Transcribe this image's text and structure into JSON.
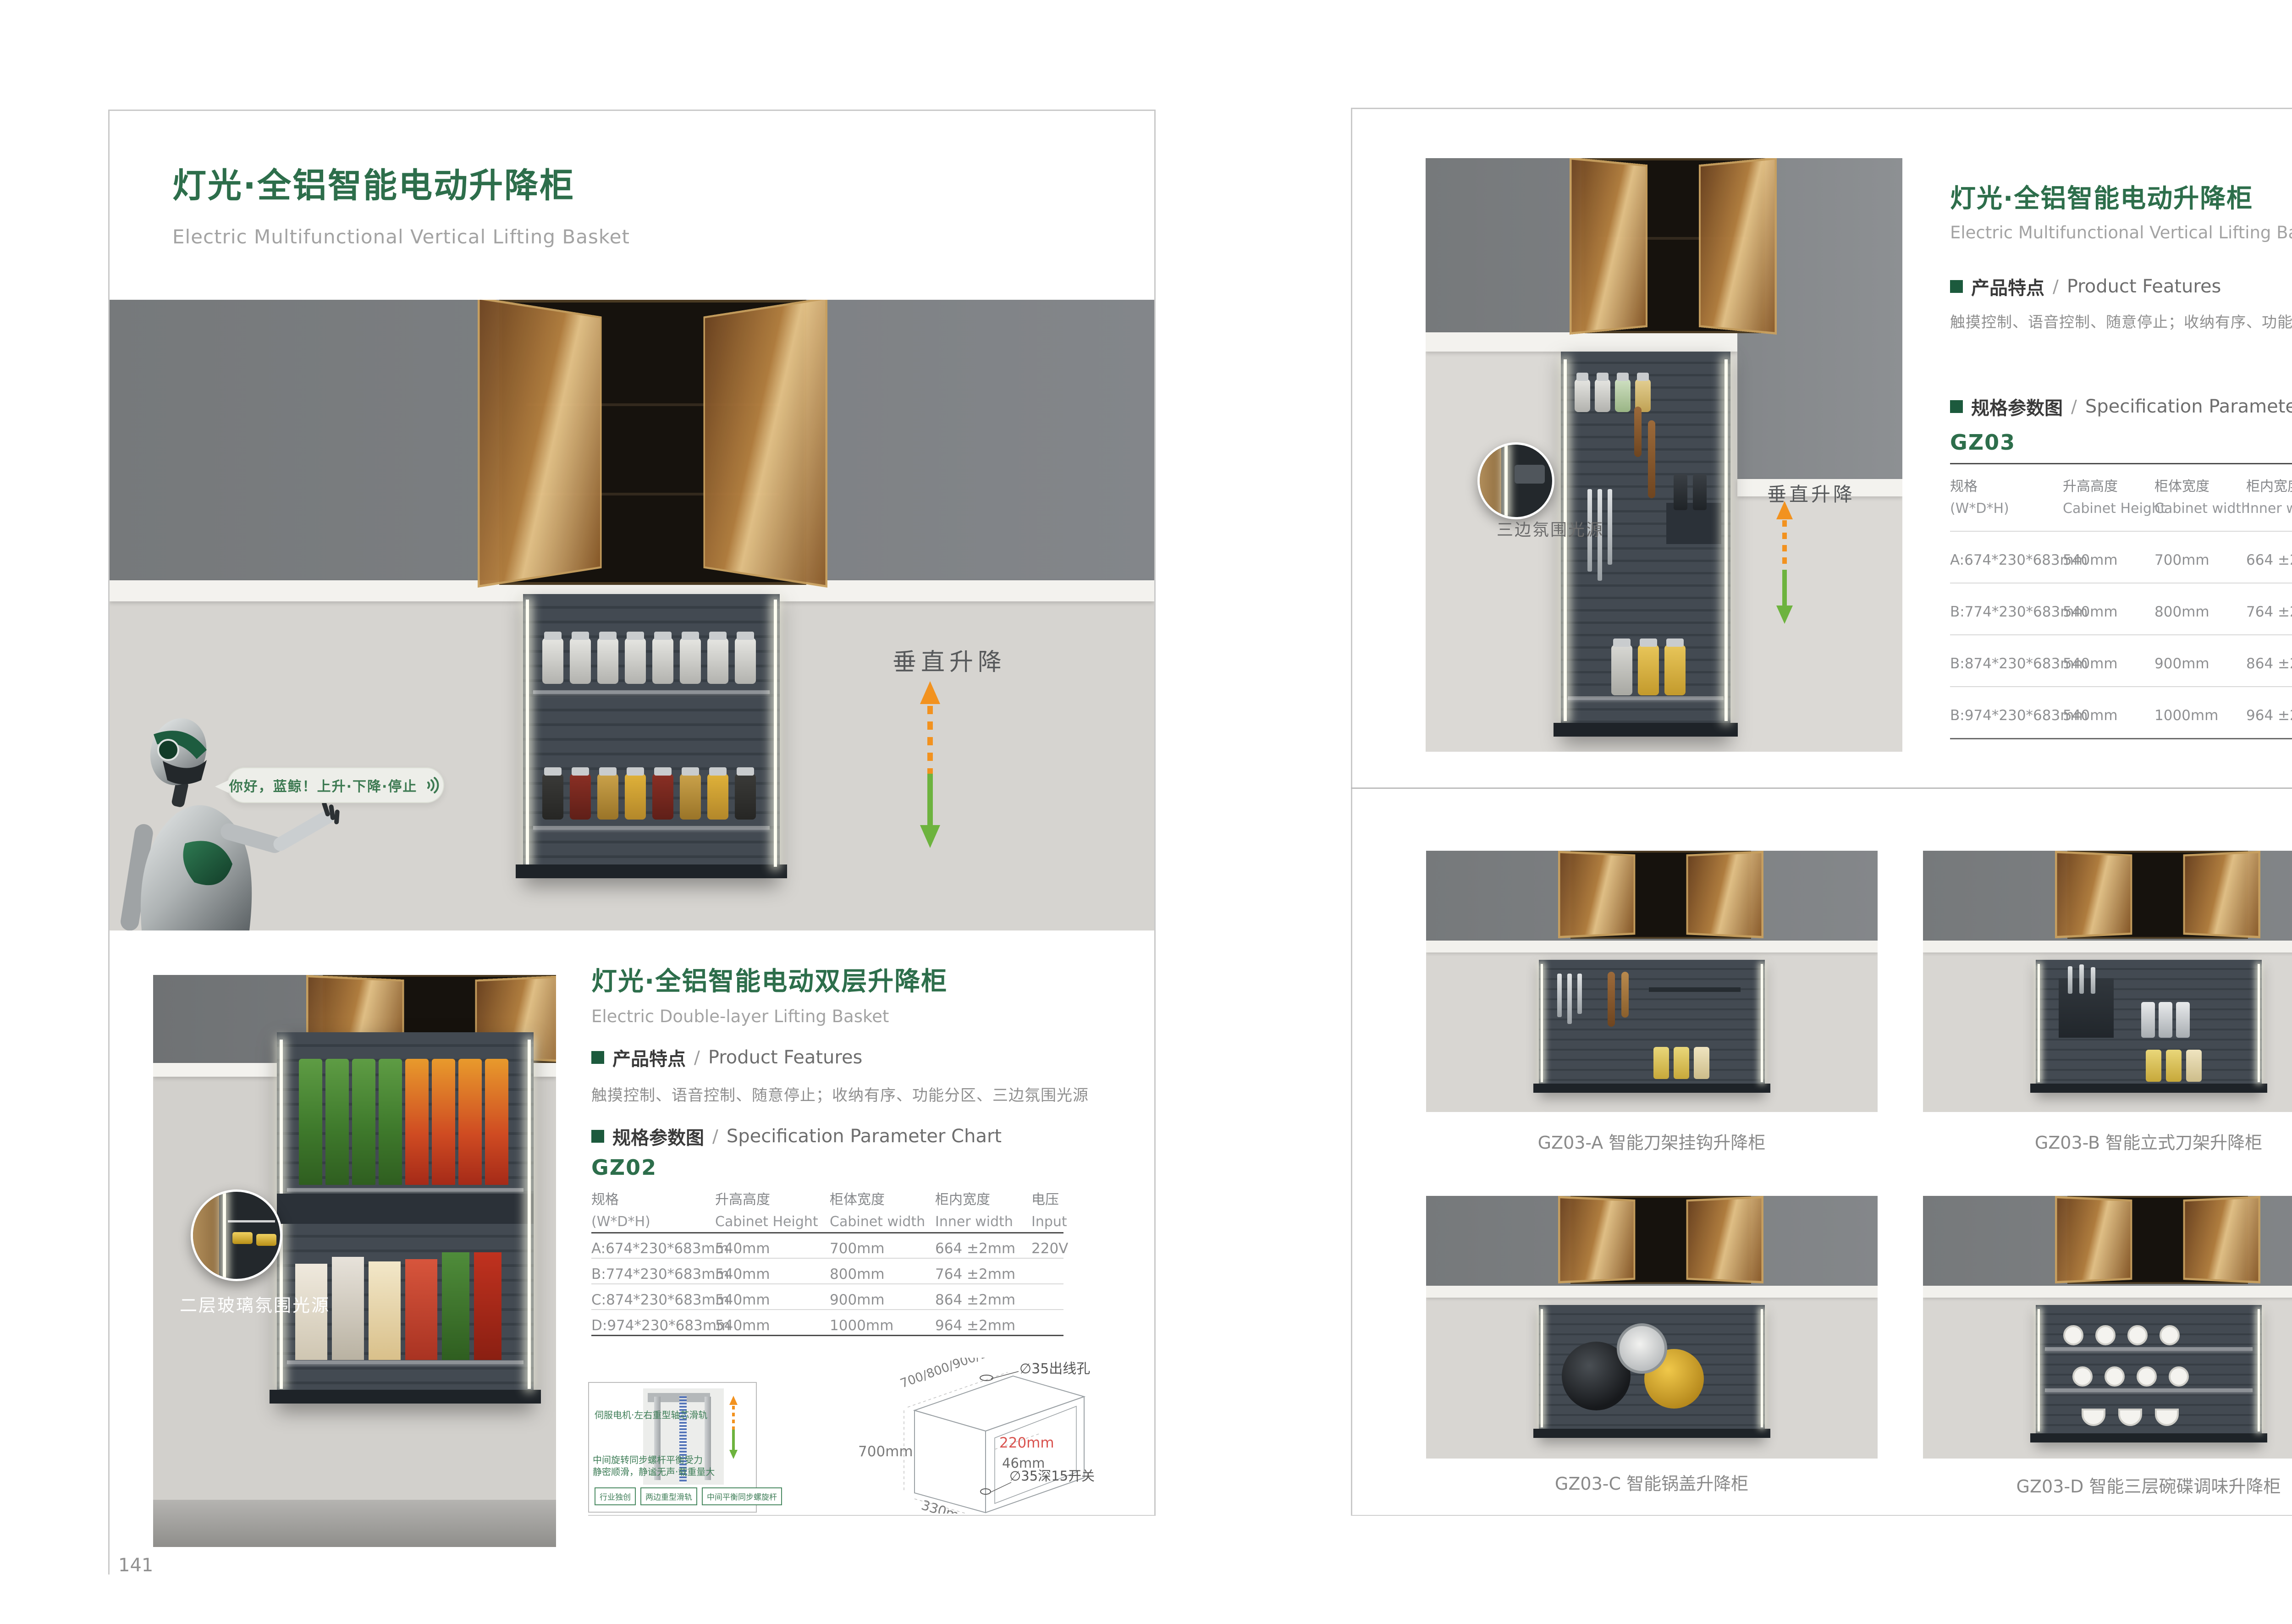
{
  "colors": {
    "brand_green": "#2d6e4b",
    "arrow_orange": "#f2921f",
    "arrow_green": "#6db33e",
    "dim_red": "#d9534f"
  },
  "left_page": {
    "page_number": "141",
    "header": {
      "title": "灯光·全铝智能电动升降柜",
      "subtitle": "Electric Multifunctional Vertical Lifting Basket"
    },
    "hero": {
      "speech_bubble": "你好，蓝鲸！上升·下降·停止",
      "lift_label": "垂直升降"
    },
    "product2": {
      "title": "灯光·全铝智能电动双层升降柜",
      "subtitle": "Electric Double-layer Lifting Basket",
      "features_label_cn": "产品特点",
      "features_label_sep": "/",
      "features_label_en": "Product Features",
      "features_text": "触摸控制、语音控制、随意停止；收纳有序、功能分区、三边氛围光源",
      "spec_label_cn": "规格参数图",
      "spec_label_sep": "/",
      "spec_label_en": "Specification Parameter Chart",
      "model": "GZ02",
      "photo_label": "二层玻璃氛围光源",
      "table": {
        "headers": [
          {
            "cn": "规格",
            "en": "(W*D*H)"
          },
          {
            "cn": "升高高度",
            "en": "Cabinet Height"
          },
          {
            "cn": "柜体宽度",
            "en": "Cabinet width"
          },
          {
            "cn": "柜内宽度",
            "en": "Inner width"
          },
          {
            "cn": "电压",
            "en": "Input"
          }
        ],
        "rows": [
          [
            "A:674*230*683mm",
            "540mm",
            "700mm",
            "664 ±2mm",
            "220V"
          ],
          [
            "B:774*230*683mm",
            "540mm",
            "800mm",
            "764 ±2mm",
            ""
          ],
          [
            "C:874*230*683mm",
            "540mm",
            "900mm",
            "864 ±2mm",
            ""
          ],
          [
            "D:974*230*683mm",
            "540mm",
            "1000mm",
            "964 ±2mm",
            ""
          ]
        ]
      },
      "mechanism": {
        "label_rail": "伺服电机·左右重型轴芯滑轨",
        "label_screw_1": "中间旋转同步螺杆平衡受力",
        "label_screw_2": "静密顺滑，静谧无声·载重量大",
        "tags": [
          "行业独创",
          "两边重型滑轨",
          "中间平衡同步螺旋杆"
        ]
      },
      "dimensions": {
        "widths": "700/800/900/1000mm",
        "hole": "∅35出线孔",
        "height": "700mm",
        "inner_depth": "220mm",
        "gap": "46mm",
        "switch": "∅35深15开关",
        "depth": "330mm"
      }
    }
  },
  "right_page": {
    "page_number": "142",
    "product": {
      "title": "灯光·全铝智能电动升降柜",
      "subtitle": "Electric Multifunctional Vertical Lifting Basket",
      "features_label_cn": "产品特点",
      "features_label_sep": "/",
      "features_label_en": "Product Features",
      "features_text": "触摸控制、语音控制、随意停止；收纳有序、功能分区、三边氛围光源",
      "spec_label_cn": "规格参数图",
      "spec_label_sep": "/",
      "spec_label_en": "Specification Parameter Chart",
      "model": "GZ03",
      "photo_label": "三边氛围光源",
      "lift_label": "垂直升降",
      "table": {
        "headers": [
          {
            "cn": "规格",
            "en": "(W*D*H)"
          },
          {
            "cn": "升高高度",
            "en": "Cabinet Height"
          },
          {
            "cn": "柜体宽度",
            "en": "Cabinet width"
          },
          {
            "cn": "柜内宽度",
            "en": "Inner width"
          },
          {
            "cn": "电压",
            "en": "Input"
          }
        ],
        "rows": [
          [
            "A:674*230*683mm",
            "540mm",
            "700mm",
            "664 ±2mm",
            "220V"
          ],
          [
            "B:774*230*683mm",
            "540mm",
            "800mm",
            "764 ±2mm",
            ""
          ],
          [
            "B:874*230*683mm",
            "540mm",
            "900mm",
            "864 ±2mm",
            ""
          ],
          [
            "B:974*230*683mm",
            "540mm",
            "1000mm",
            "964 ±2mm",
            ""
          ]
        ]
      }
    },
    "gallery": [
      {
        "caption": "GZ03-A  智能刀架挂钩升降柜"
      },
      {
        "caption": "GZ03-B  智能立式刀架升降柜"
      },
      {
        "caption": "GZ03-C  智能锅盖升降柜"
      },
      {
        "caption": "GZ03-D  智能三层碗碟调味升降柜"
      }
    ]
  }
}
